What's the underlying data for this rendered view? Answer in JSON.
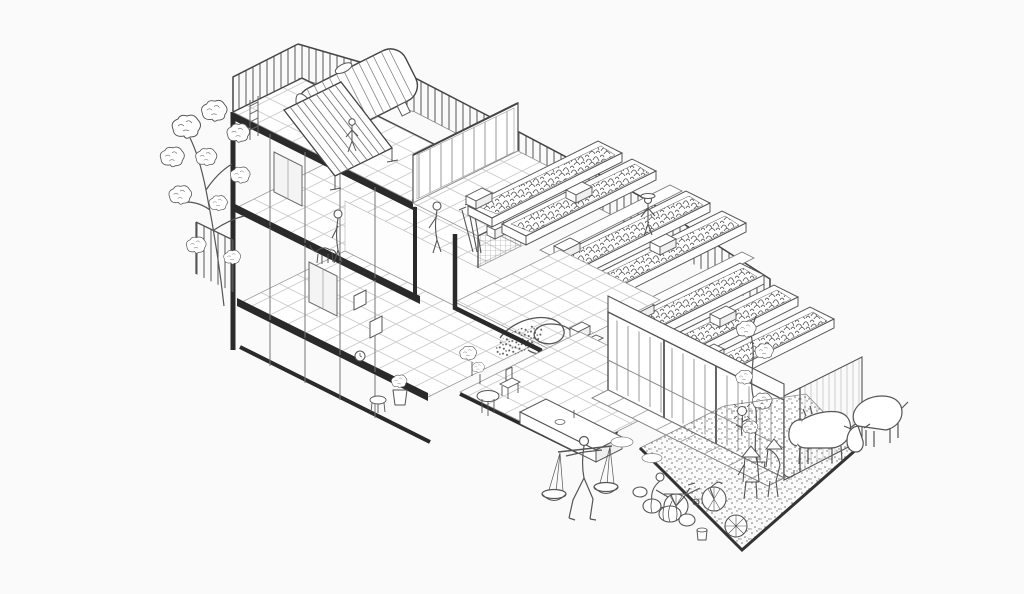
{
  "canvas": {
    "width": 1024,
    "height": 594,
    "background": "#fafafa"
  },
  "palette": {
    "ink": "#444444",
    "ink_soft": "#777777",
    "ink_dark": "#2a2a2a",
    "grid_line": "#c9c9c9",
    "paper": "#ffffff",
    "foliage_stroke": "#4f4f4f",
    "gravel_dot": "#6e6e6e"
  },
  "scene": {
    "type": "hand-drawn axonometric cutaway line illustration",
    "rooftop_terrace": {
      "water_tank": 1,
      "solar_collector": 1,
      "ladder": 1,
      "perimeter_railing": true,
      "standing_figure": 1
    },
    "green_roof_farm": {
      "planter_beds": 7,
      "stepped_levels": 3,
      "stepping_blocks": 7,
      "gardener_with_sun_hat": 1,
      "garden_hose": 1,
      "produce_drying_patch": 1,
      "crates": 2
    },
    "left_wing_cutaway": {
      "storeys": 2,
      "tiled_floors": 2,
      "resident_with_dog": 1,
      "framed_pictures": 2,
      "dark_door_panels": 2,
      "windows": 2,
      "balcony_railing": 1,
      "street_tree": 1
    },
    "mid_terrace": {
      "glass_bulkhead": 1,
      "mesh_railing": 1,
      "garden_tools": 3,
      "crate": 1,
      "figure": 1
    },
    "ground_room": {
      "tiled_floor": 1,
      "long_bench": 1,
      "table": 1,
      "chair": 1,
      "potted_plants": 2
    },
    "street_wing": {
      "glass_facade": 1,
      "corner_post": 1,
      "hatched_end_wall": 1,
      "climbing_vine_in_pot": 1
    },
    "yard": {
      "paved_strip": 1,
      "gravel_patch": 1,
      "bicycle": 1,
      "person_repairing_bicycle": 1,
      "farmers_in_conical_hats": 2,
      "pumpkins": 4,
      "spare_wheel": 1,
      "bucket": 1,
      "sunflower": 1,
      "goats": 2
    },
    "street": {
      "vendor_with_balance_baskets": 1
    }
  }
}
